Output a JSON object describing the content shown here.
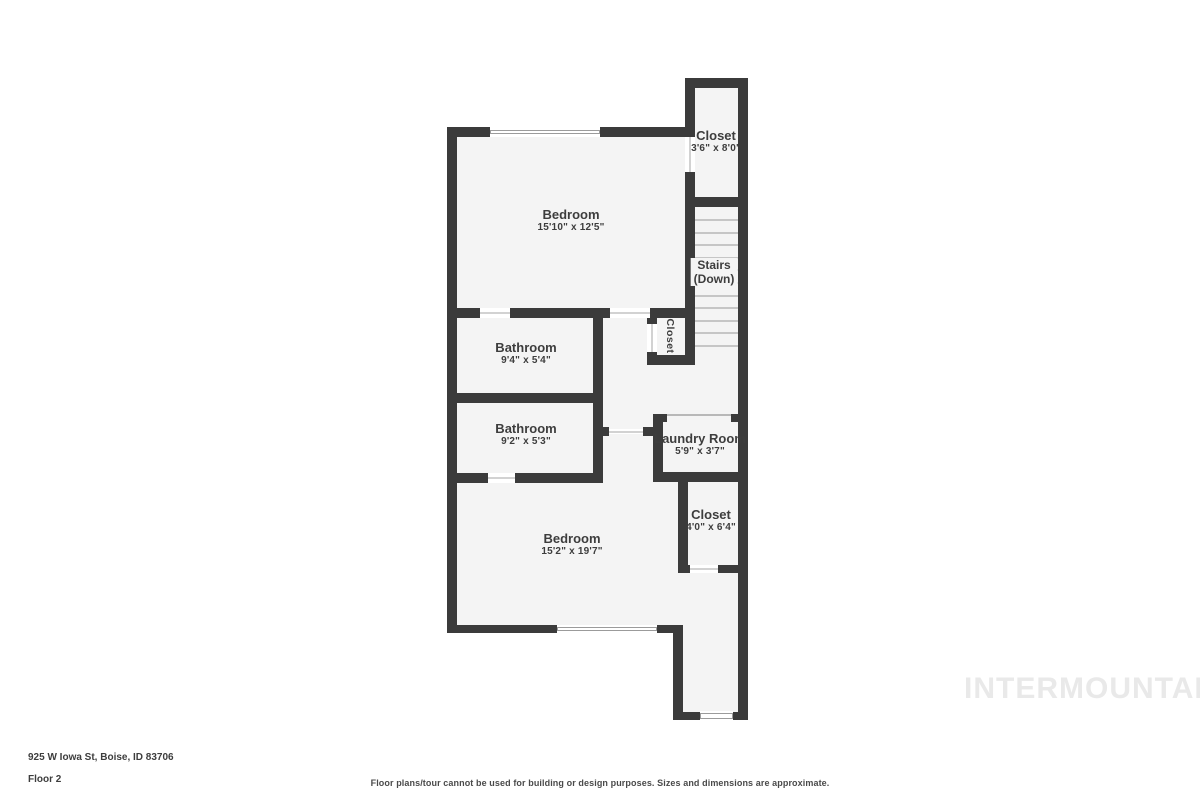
{
  "floorplan": {
    "watermark": "INTERMOUNTAIN",
    "footer": {
      "address": "925 W Iowa St, Boise, ID 83706",
      "floor_label": "Floor 2",
      "disclaimer": "Floor plans/tour cannot be used for building or design purposes. Sizes and dimensions are approximate."
    },
    "rooms": {
      "closet_top": {
        "name": "Closet",
        "dims": "3'6\" x 8'0\""
      },
      "bedroom_1": {
        "name": "Bedroom",
        "dims": "15'10\" x 12'5\""
      },
      "stairs": {
        "name": "Stairs",
        "name2": "(Down)"
      },
      "closet_hall": {
        "name": "Closet"
      },
      "bathroom_1": {
        "name": "Bathroom",
        "dims": "9'4\" x 5'4\""
      },
      "bathroom_2": {
        "name": "Bathroom",
        "dims": "9'2\" x 5'3\""
      },
      "laundry": {
        "name": "Laundry Room",
        "dims": "5'9\" x 3'7\""
      },
      "closet_2": {
        "name": "Closet",
        "dims": "4'0\" x 6'4\""
      },
      "bedroom_2": {
        "name": "Bedroom",
        "dims": "15'2\" x 19'7\""
      }
    },
    "colors": {
      "wall": "#3b3b3b",
      "floor": "#f4f4f4",
      "text": "#3d3d3d",
      "watermark": "#e9e9e9"
    }
  }
}
